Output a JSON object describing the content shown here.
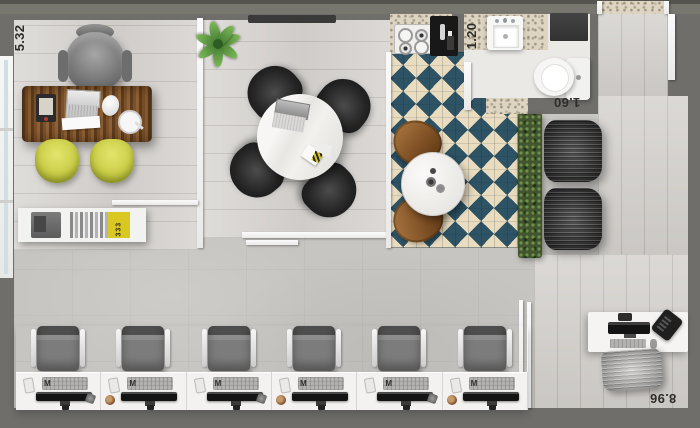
{
  "floor_plan": {
    "dimensions": {
      "office": "5.32",
      "bath_width": "1.20",
      "bath_length": "1.60",
      "open_office": "8.96"
    },
    "objects": {
      "book_label": "333",
      "keyboard_badge": "M"
    },
    "palette": {
      "wall": "#6f6e6b",
      "wood_floor": "#d8d5d1",
      "concrete_floor": "#c7c5c1",
      "corridor_floor": "#d5d2ce",
      "checker_teal": "#2d5365",
      "checker_cream": "#e9dcbf",
      "guest_chair_yellow": "#c6ca41",
      "desk_wood_brown": "#7c5129",
      "hedge_green": "#42552f",
      "bathroom_floor": "#ebe9e6",
      "counter_beige": "#ddd5c2"
    }
  }
}
